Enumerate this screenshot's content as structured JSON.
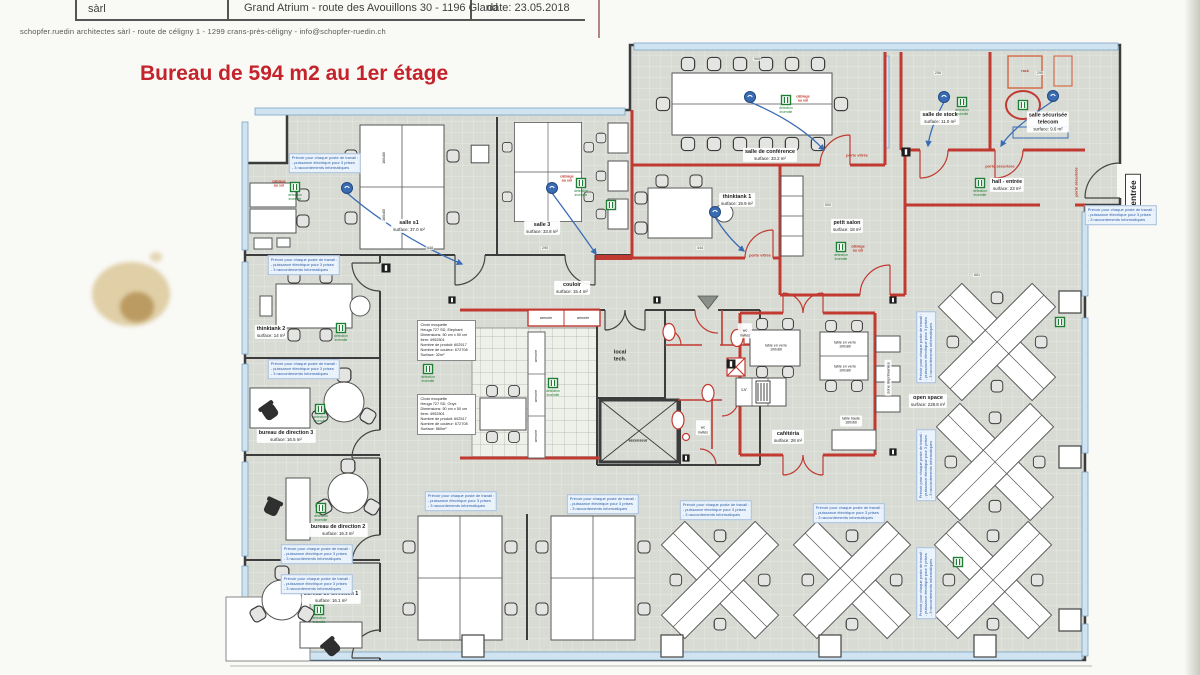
{
  "header": {
    "company_abbrev": "sàrl",
    "project_line": "Grand Atrium - route des Avouillons 30 - 1196 Gland",
    "date_line": "date: 23.05.2018",
    "address_line": "schopfer.ruedin architectes sàrl  -  route de céligny 1  -  1299 crans-près-céligny  -  info@schopfer-ruedin.ch",
    "title": "Bureau de 594 m2 au 1er étage"
  },
  "rooms": {
    "salle1": {
      "label": "salle s1",
      "surface": "surface: 37.0 m²"
    },
    "salle3": {
      "label": "salle 3",
      "surface": "surface: 33.8 m²"
    },
    "conference": {
      "label": "salle de conférence",
      "surface": "surface: 33.2 m²"
    },
    "thinktank1": {
      "label": "thinktank 1",
      "surface": "surface: 19.9 m²"
    },
    "petit_salon": {
      "label": "petit salon",
      "surface": "surface: 18 m²"
    },
    "stock": {
      "label": "salle de stock",
      "surface": "surface: 11.0 m²"
    },
    "telecom": {
      "label": "salle sécurisée\ntelecom",
      "surface": "surface: 9.6 m²"
    },
    "hall": {
      "label": "hall - entrée",
      "surface": "surface: 23 m²"
    },
    "couloir": {
      "label": "couloir",
      "surface": "surface: 15.4 m²"
    },
    "thinktank2": {
      "label": "thinktank 2",
      "surface": "surface: 14 m²"
    },
    "direction3": {
      "label": "bureau de direction 3",
      "surface": "surface: 16.5 m²"
    },
    "direction2": {
      "label": "bureau de direction 2",
      "surface": "surface: 16.3 m²"
    },
    "direction1": {
      "label": "bureau de direction 1",
      "surface": "surface: 16.1 m²"
    },
    "open_space": {
      "label": "open space",
      "surface": "surface: 228.8 m²"
    },
    "cafeteria": {
      "label": "cafétéria",
      "surface": "surface: 28 m²"
    },
    "local_tech": {
      "label": "local\ntech."
    },
    "ascenseur": {
      "label": "ascenseur"
    },
    "wc": {
      "label": "wc\ninvités"
    }
  },
  "doors": {
    "porte_vitree": "porte vitrée",
    "porte_securisee": "porte sécurisée",
    "entree": "entrée"
  },
  "furniture": {
    "armoire": "armoire",
    "lv": "LV",
    "rack": "rack",
    "table_verre": "table en verre\n100x80",
    "table_haute": "table haute\n160x60",
    "zone_imprimantes": "zone imprimantes",
    "desk_size": "160x80"
  },
  "annotations": {
    "workstation_note": "Prévoir pour chaque poste de travail :\n- puissance électrique pour 3 prises\n- 3 raccordements informatiques",
    "moquette_note_1": "Choix moquette\nHeuga 727 SD, Elephant\nDimensions: 50 cm x 50 cm\nItem: 4952501\nNombre de produit: 602517\nNombre de couleur: 672708\nSurface: 32m²",
    "moquette_note_2": "Choix moquette\nHeuga 727 SD, Onyx\nDimensions: 50 cm x 50 cm\nItem: 4952501\nNombre de produit: 602517\nNombre de couleur: 672708\nSurface: 560m²",
    "marker_green_caption": "détection\nincendie",
    "marker_red_caption": "câblage\nau sol"
  },
  "dimensions": {
    "d1": "960",
    "d2": "256",
    "d3": "290",
    "d4": "500",
    "d5": "444",
    "d6": "448",
    "d7": "290",
    "d8": "881"
  },
  "colors": {
    "wall_red": "#c13a32",
    "annotation_blue": "#2d5fa8",
    "marker_green": "#1e7e34",
    "title_red": "#c4232b",
    "window_blue": "#cfe3f0",
    "floor_gray": "#d7dbd3"
  }
}
